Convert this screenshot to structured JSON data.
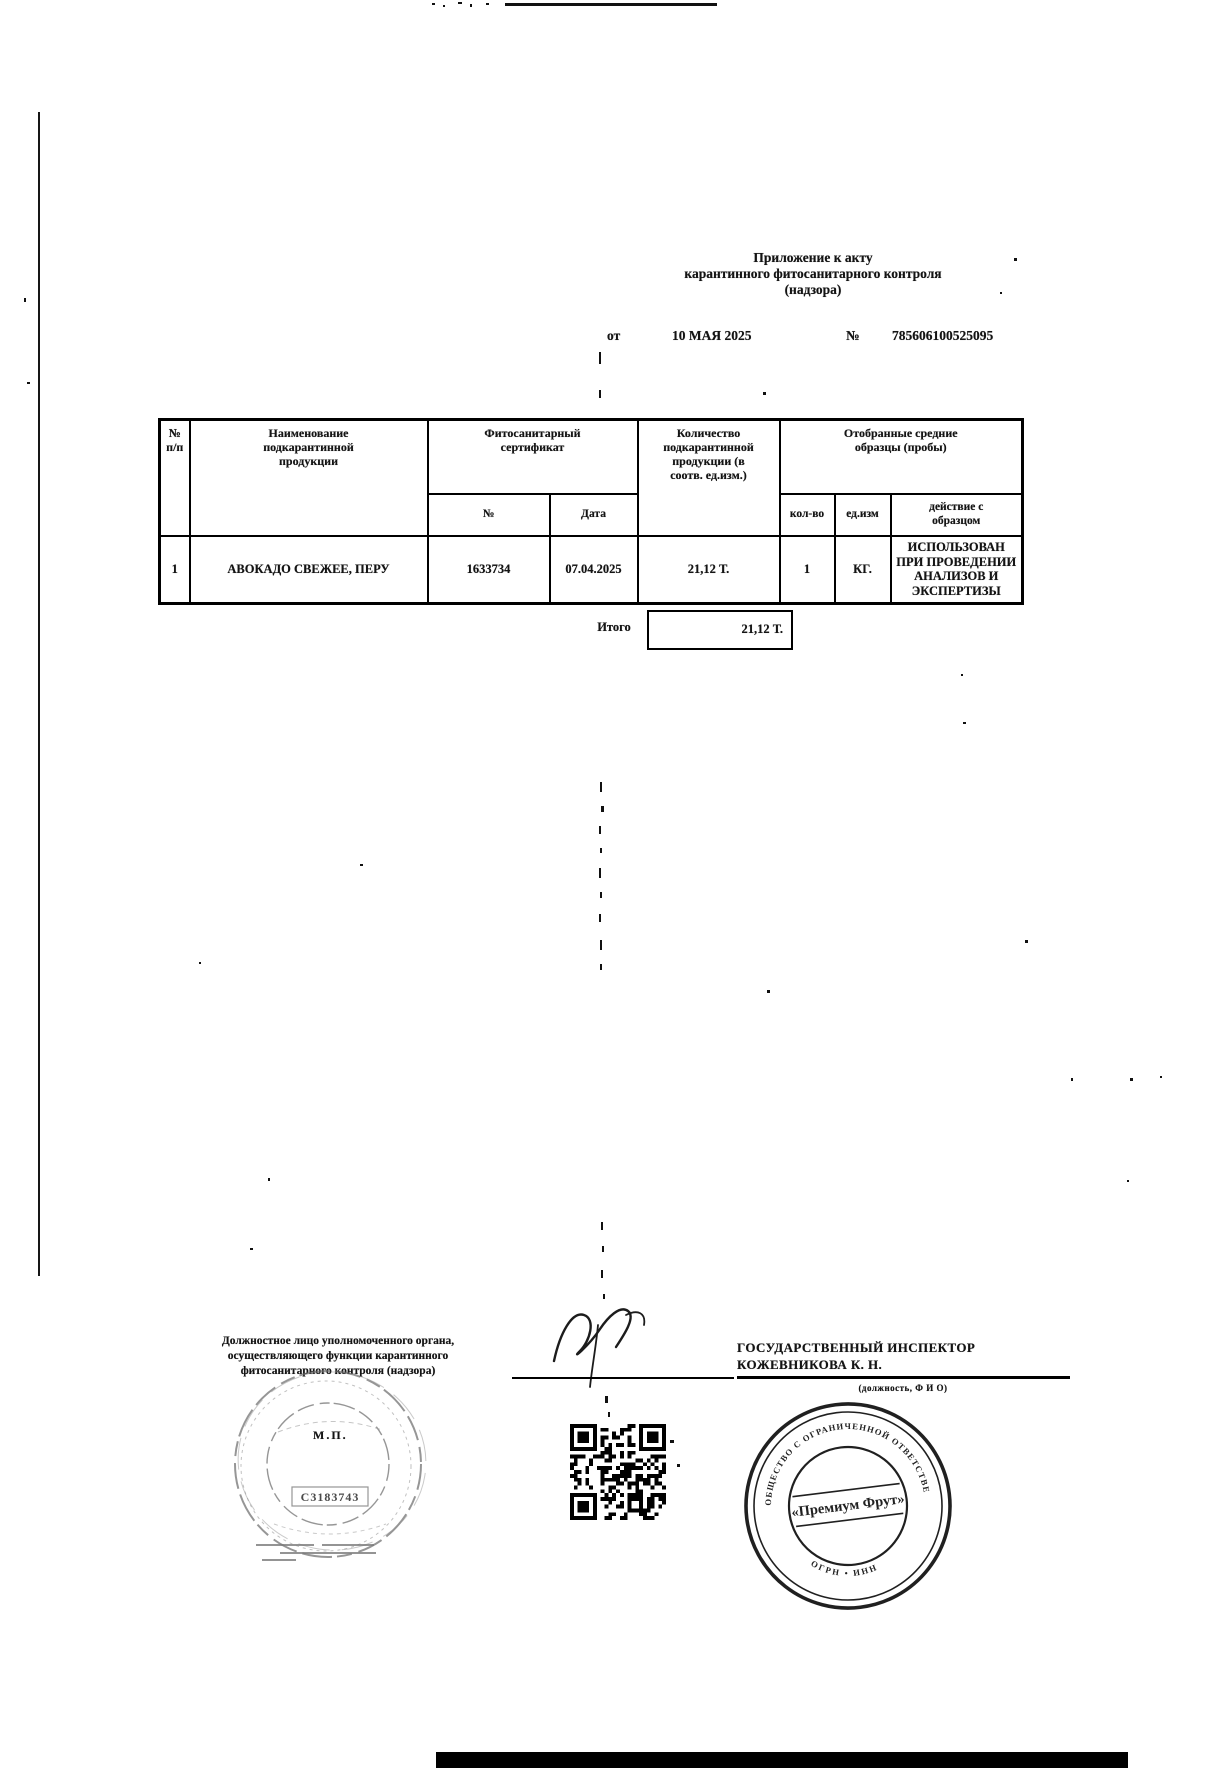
{
  "document": {
    "top_header": "Приложение к акту\nкарантинного фитосанитарного контроля\n(надзора)",
    "ref": {
      "from_label": "от",
      "date": "10 МАЯ 2025",
      "no_label": "№",
      "number": "785606100525095"
    }
  },
  "table": {
    "headers": {
      "num": "№\nп/п",
      "product": "Наименование\nподкарантинной\nпродукции",
      "certificate": "Фитосанитарный\nсертификат",
      "cert_no": "№",
      "cert_date": "Дата",
      "quantity": "Количество\nподкарантинной\nпродукции (в\nсоотв. ед.изм.)",
      "samples": "Отобранные средние\nобразцы (пробы)",
      "count": "кол-во",
      "unit": "ед.изм",
      "action": "действие с\nобразцом"
    },
    "rows": [
      {
        "num": "1",
        "product": "АВОКАДО СВЕЖЕЕ, ПЕРУ",
        "cert_no": "1633734",
        "cert_date": "07.04.2025",
        "quantity": "21,12 Т.",
        "count": "1",
        "unit": "КГ.",
        "action": "ИСПОЛЬЗОВАН\nПРИ ПРОВЕДЕНИИ\nАНАЛИЗОВ И\nЭКСПЕРТИЗЫ"
      }
    ],
    "total": {
      "label": "Итого",
      "value": "21,12 Т."
    }
  },
  "footer": {
    "official": "Должностное лицо уполномоченного органа,\nосуществляющего функции карантинного\nфитосанитарного контроля (надзора)",
    "stamp_mark": "М.П.",
    "inspector_title": "ГОСУДАРСТВЕННЫЙ ИНСПЕКТОР",
    "inspector_name": "КОЖЕВНИКОВА К. Н.",
    "caption": "(должность, Ф И О)"
  },
  "stamps": {
    "left_number": "С3183743",
    "right_center": "«Премиум Фрут»",
    "right_ring_top": "ОБЩЕСТВО С ОГРАНИЧЕННОЙ ОТВЕТСТВЕННОСТЬЮ",
    "right_ring_bottom": "ОГРН • ИНН"
  },
  "colors": {
    "ink": "#141414",
    "stamp_faint": "#6a6a6a"
  }
}
